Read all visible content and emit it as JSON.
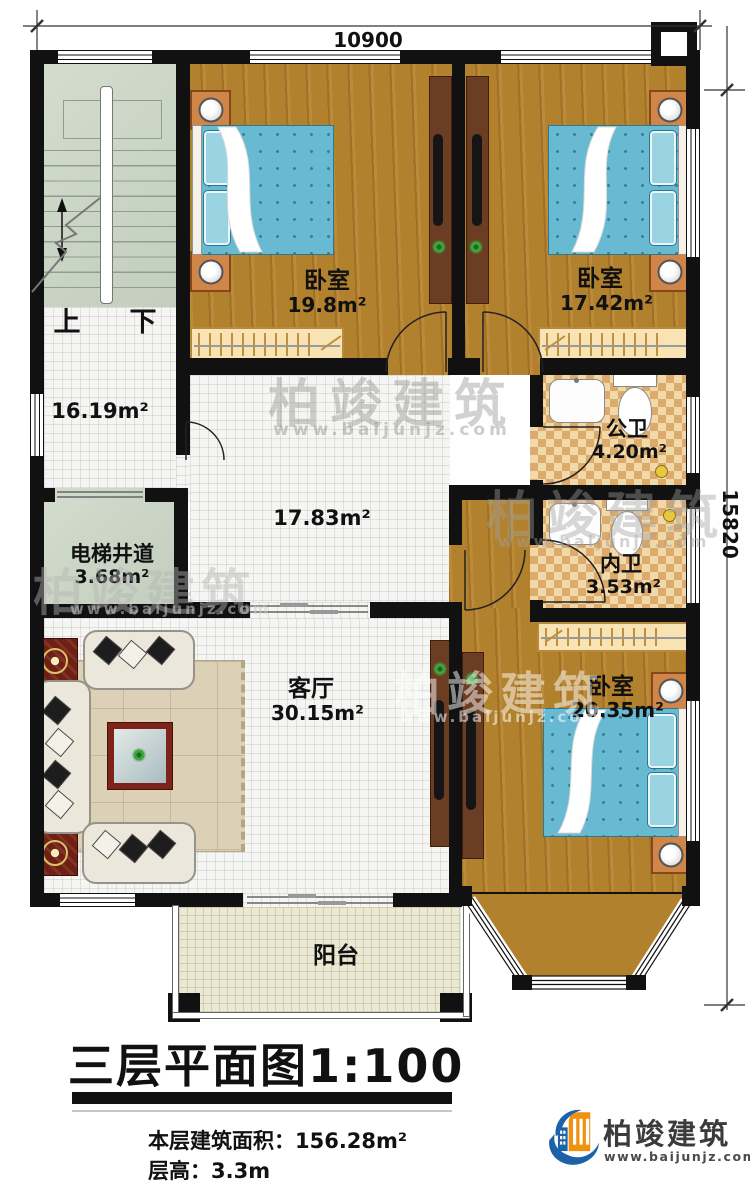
{
  "dimensions": {
    "width_top": "10900",
    "height_right": "15820"
  },
  "stairwell": {
    "up": "上",
    "down": "下"
  },
  "rooms": {
    "hall_upper": {
      "area": "16.19m²"
    },
    "hall_main": {
      "area": "17.83m²"
    },
    "bedroom_left": {
      "name": "卧室",
      "area": "19.8m²"
    },
    "bedroom_right": {
      "name": "卧室",
      "area": "17.42m²"
    },
    "bedroom_master": {
      "name": "卧室",
      "area": "20.35m²"
    },
    "public_bath": {
      "name": "公卫",
      "area": "4.20m²"
    },
    "private_bath": {
      "name": "内卫",
      "area": "3.53m²"
    },
    "elevator": {
      "name": "电梯井道",
      "area": "3.68m²"
    },
    "living": {
      "name": "客厅",
      "area": "30.15m²"
    },
    "balcony": {
      "name": "阳台"
    }
  },
  "title": {
    "main": "三层平面图",
    "scale": "1:100",
    "area_label": "本层建筑面积：156.28m²",
    "floor_height_label": "层高：3.3m"
  },
  "brand": {
    "name": "柏竣建筑",
    "url": "www.baijunjz.com"
  },
  "watermark": {
    "name": "柏竣建筑",
    "url": "www.baijunjz.com"
  },
  "colors": {
    "wall": "#111111",
    "wood": "#b2812e",
    "bed": "#67bad1",
    "brand_blue": "#1b62a8",
    "brand_orange": "#f0920f"
  }
}
